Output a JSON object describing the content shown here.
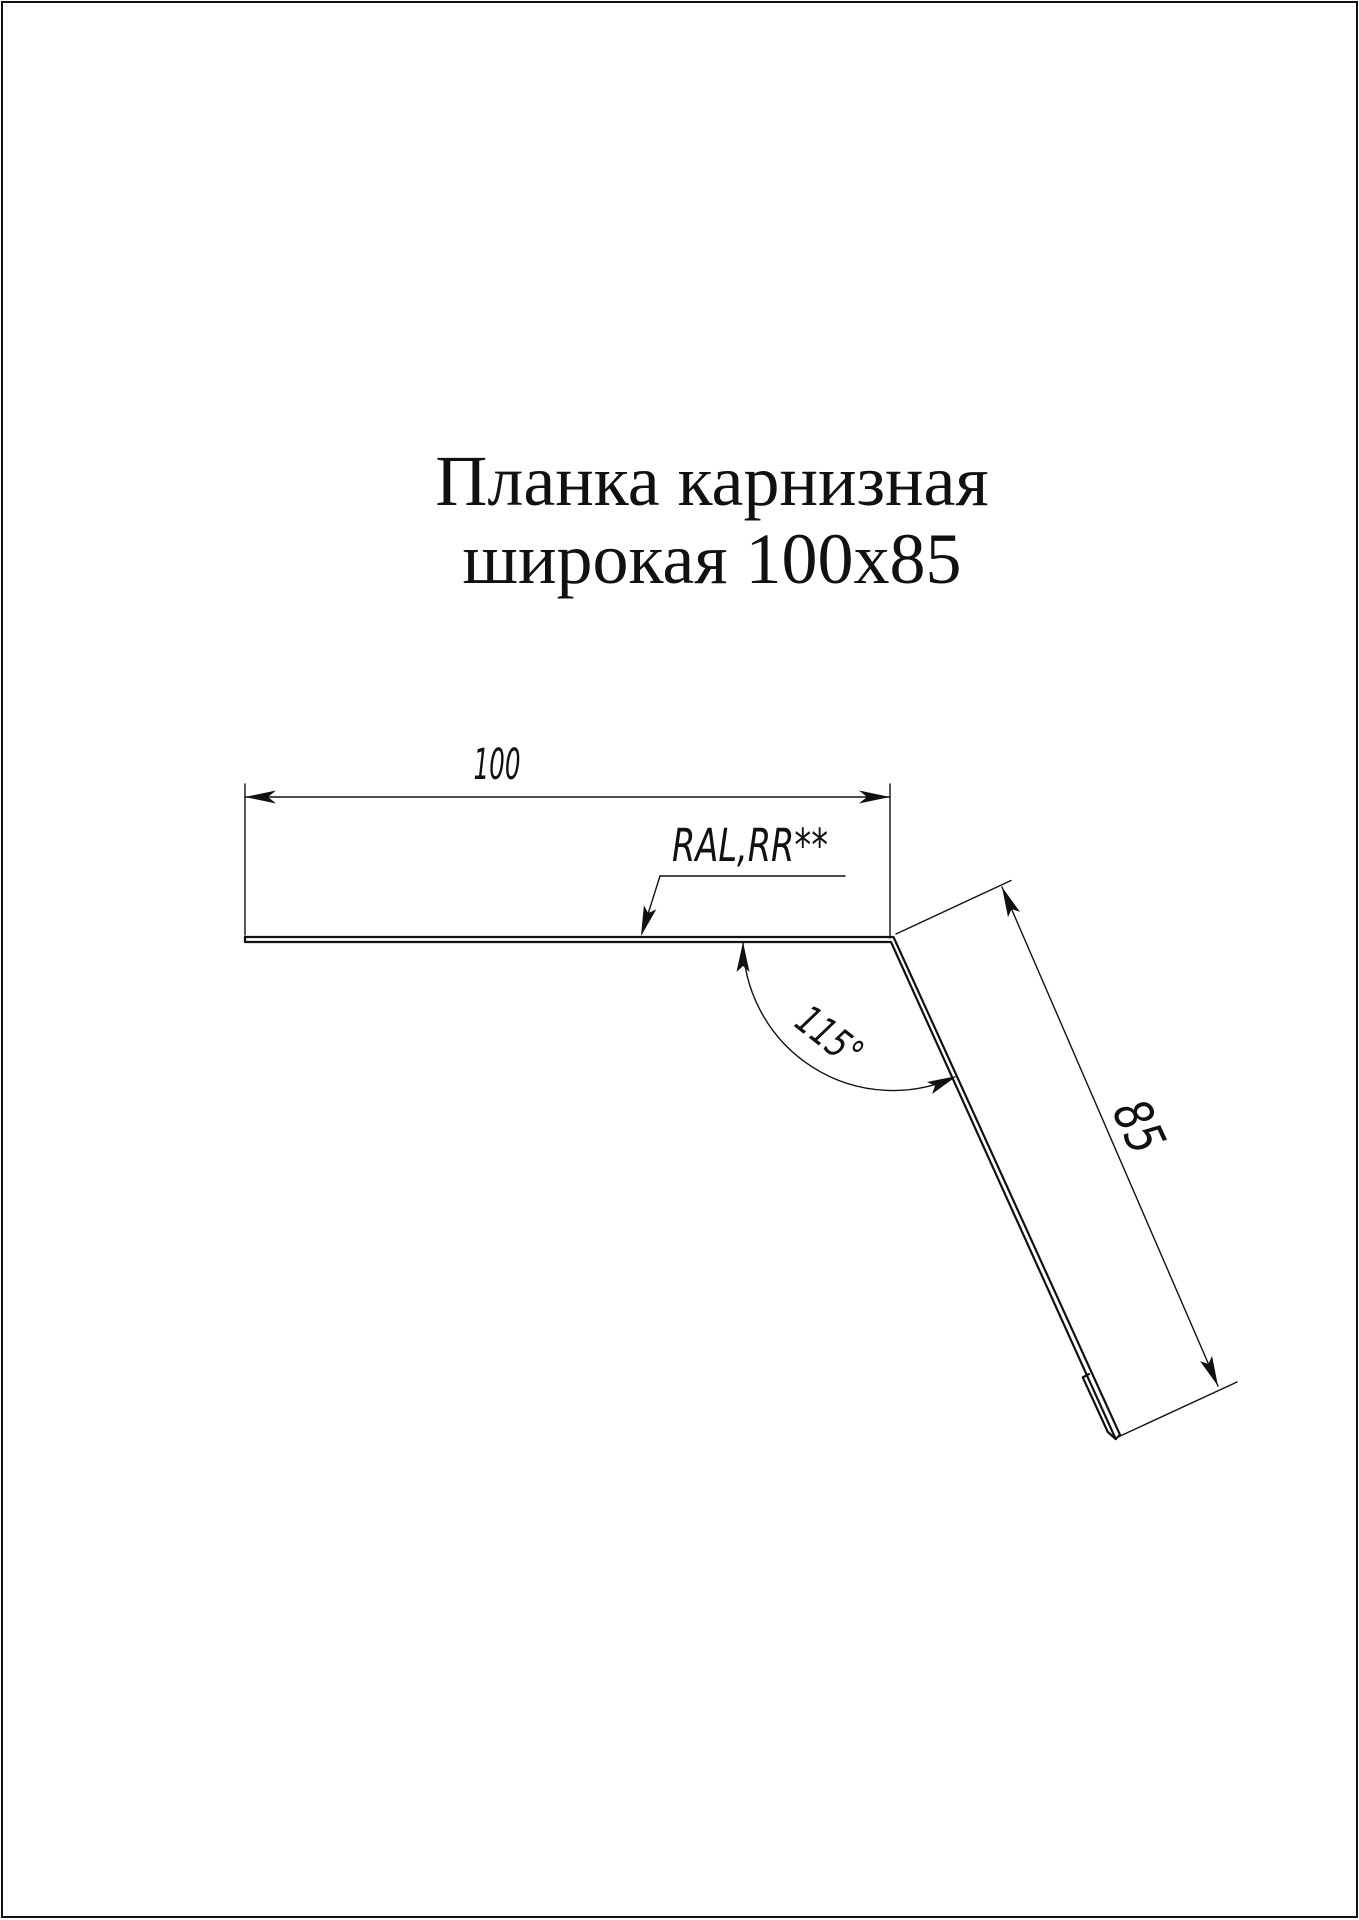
{
  "page": {
    "background": "#ffffff",
    "frame_color": "#111111",
    "title": {
      "line1": "Планка карнизная",
      "line2": "широкая 100х85"
    }
  },
  "drawing": {
    "line_color": "#111111",
    "labels": {
      "width_dim": "100",
      "length_dim": "85",
      "bend_angle": "115°",
      "coating_note": "RAL,RR**"
    }
  }
}
